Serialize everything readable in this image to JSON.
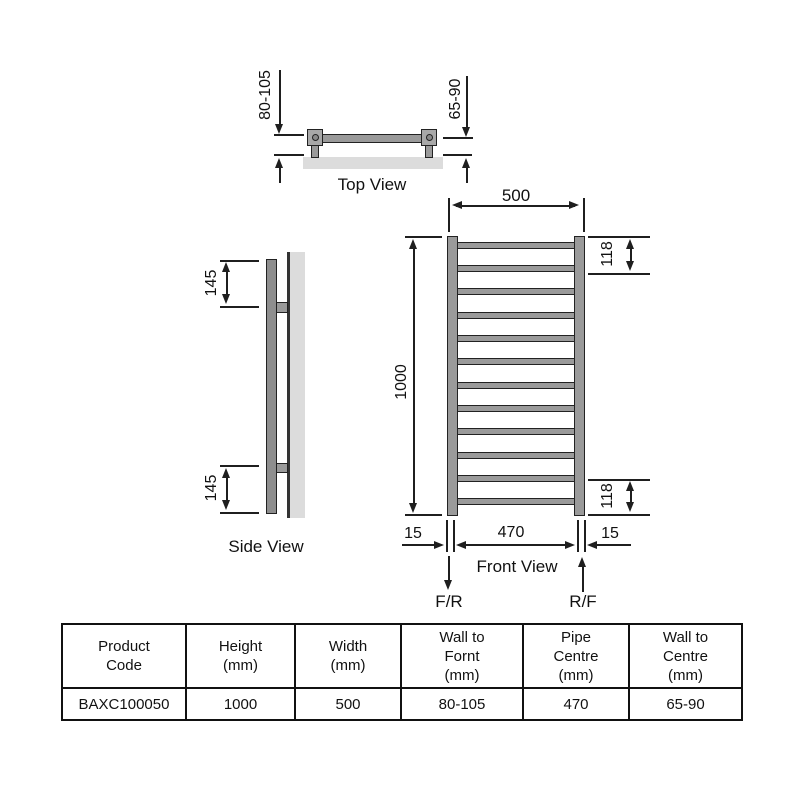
{
  "top_view": {
    "label": "Top View",
    "wall_to_front": "80-105",
    "wall_to_centre": "65-90"
  },
  "side_view": {
    "label": "Side View",
    "bracket_from_top": "145",
    "bracket_from_bottom": "145"
  },
  "front_view": {
    "label": "Front View",
    "width": "500",
    "height": "1000",
    "top_rung_offset": "118",
    "bottom_rung_offset": "118",
    "pipe_inset_left": "15",
    "pipe_centres": "470",
    "pipe_inset_right": "15",
    "flow_left": "F/R",
    "flow_right": "R/F",
    "rung_count": 12
  },
  "table": {
    "headers": [
      "Product\nCode",
      "Height\n(mm)",
      "Width\n(mm)",
      "Wall to\nFornt\n(mm)",
      "Pipe\nCentre\n(mm)",
      "Wall to\nCentre\n(mm)"
    ],
    "row": [
      "BAXC100050",
      "1000",
      "500",
      "80-105",
      "470",
      "65-90"
    ]
  },
  "colors": {
    "line": "#1f1f1f",
    "metal": "#9a9a9a",
    "wall": "#dcdcdc",
    "background": "#ffffff",
    "text": "#111111"
  }
}
